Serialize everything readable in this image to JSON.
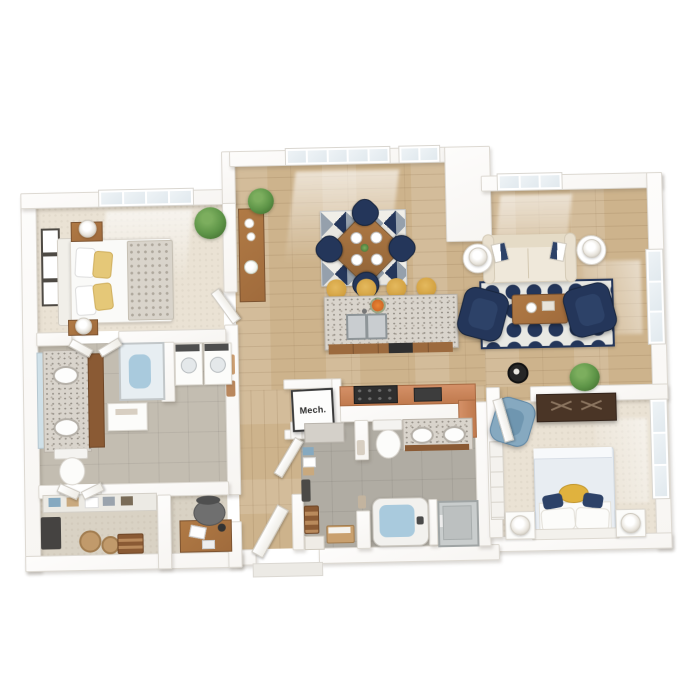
{
  "labels": {
    "mech_closet": "Mech."
  },
  "colors": {
    "wall": "#f7f5f2",
    "walledge": "#ddd9d2",
    "wood": "#cdb38c",
    "carpet": "#eae2d4",
    "tile": "#b0aca3",
    "navy": "#24365a",
    "navy2": "#2d4268",
    "mustard": "#d2a03f",
    "cream": "#efe8da",
    "granite": "#d9d4cc",
    "woodfurn": "#a06b3c",
    "wooddeep": "#4a3526",
    "water": "#a9cadd",
    "softblue": "#86a9c0",
    "green": "#5d9447",
    "stainless": "#c9cdd0",
    "appliance_dark": "#2f2f2f"
  },
  "scene": {
    "view": "3d-top-down-apartment-floor-plan",
    "rooms": [
      {
        "name": "bedroom-1",
        "furniture": [
          "bed",
          "nightstand",
          "nightstand",
          "lamp",
          "lamp",
          "wall-frames",
          "plant",
          "window"
        ]
      },
      {
        "name": "master-bathroom",
        "furniture": [
          "double-vanity",
          "mirror",
          "toilet",
          "shower",
          "linen-cabinet",
          "towels"
        ]
      },
      {
        "name": "laundry-closet",
        "furniture": [
          "washer",
          "dryer"
        ]
      },
      {
        "name": "walk-in-closet-1",
        "furniture": [
          "shelving",
          "baskets",
          "blanket-ladder",
          "floor-mat"
        ]
      },
      {
        "name": "office-nook",
        "furniture": [
          "desk",
          "office-chair",
          "laptop"
        ]
      },
      {
        "name": "dining-area",
        "furniture": [
          "square-table",
          "dining-chair-x4",
          "geometric-rug",
          "console-table",
          "plant",
          "plant",
          "windows"
        ]
      },
      {
        "name": "kitchen",
        "furniture": [
          "island",
          "double-sink",
          "bar-stool-x4",
          "range",
          "half-wall-counter",
          "dishwasher",
          "flowers"
        ]
      },
      {
        "name": "mechanical-closet",
        "furniture": []
      },
      {
        "name": "living-room",
        "furniture": [
          "sofa",
          "throw-pillows",
          "side-table-x2",
          "lamp-x2",
          "ogee-rug",
          "coffee-table",
          "armchair-x2",
          "plant",
          "round-tray",
          "windows"
        ]
      },
      {
        "name": "bathroom-2",
        "furniture": [
          "toilet",
          "double-vanity",
          "bathtub",
          "glass-shower",
          "towels"
        ]
      },
      {
        "name": "walk-in-closet-2",
        "furniture": [
          "shelf-unit",
          "hanging-clothes",
          "bench",
          "hamper",
          "blanket-ladder"
        ]
      },
      {
        "name": "bedroom-2",
        "furniture": [
          "bed",
          "nightstand-x2",
          "lamp-x2",
          "dresser",
          "armchair",
          "closet-shelving",
          "window"
        ]
      },
      {
        "name": "entry-hall",
        "furniture": [
          "entry-door"
        ]
      }
    ]
  }
}
